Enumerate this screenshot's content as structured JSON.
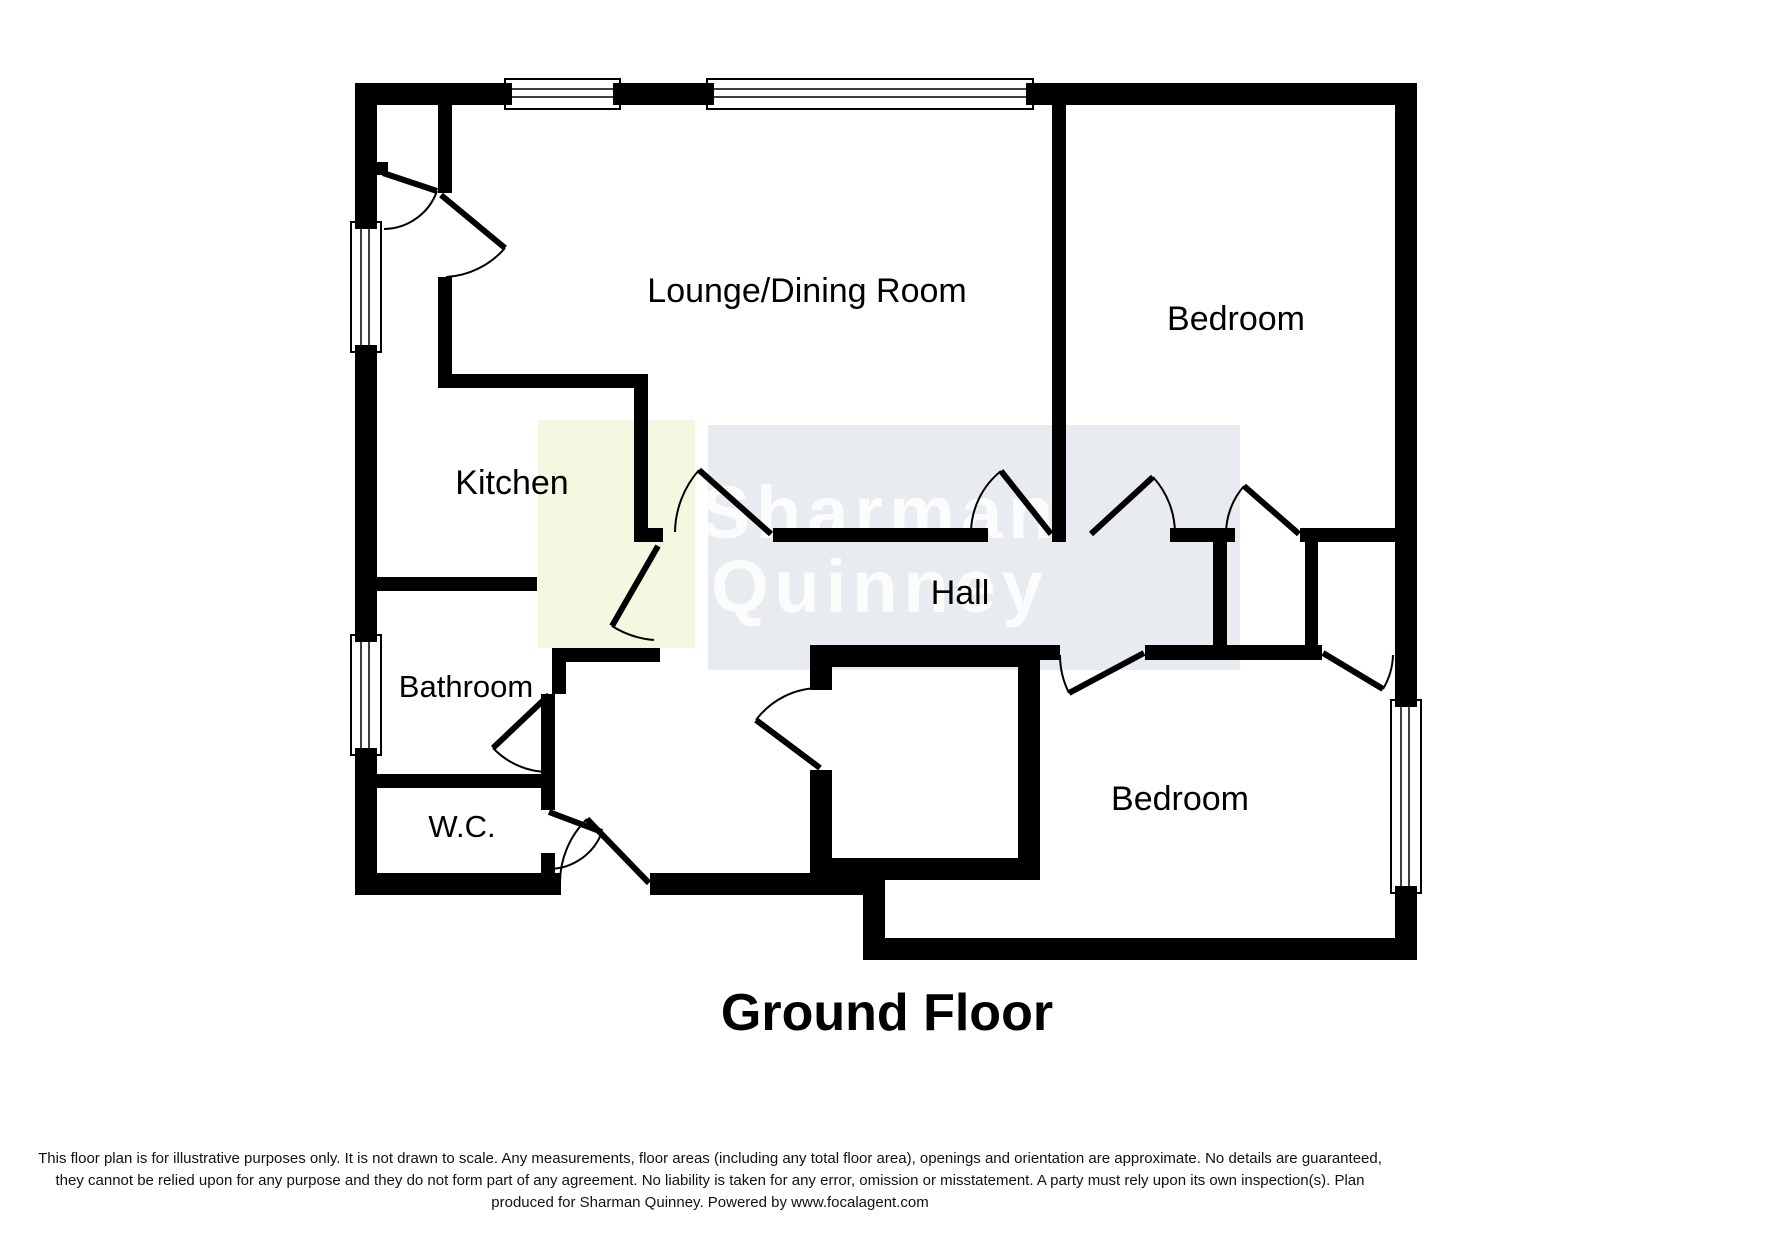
{
  "floor_plan": {
    "title": "Ground Floor",
    "brand_watermark": {
      "line1": "Sharman",
      "line2": "Quinney"
    },
    "rooms": [
      {
        "id": "lounge-dining-room",
        "label": "Lounge/Dining Room"
      },
      {
        "id": "bedroom-1",
        "label": "Bedroom"
      },
      {
        "id": "kitchen",
        "label": "Kitchen"
      },
      {
        "id": "hall",
        "label": "Hall"
      },
      {
        "id": "bathroom",
        "label": "Bathroom"
      },
      {
        "id": "wc",
        "label": "W.C."
      },
      {
        "id": "bedroom-2",
        "label": "Bedroom"
      }
    ],
    "colors": {
      "wall": "#000000",
      "background": "#ffffff",
      "kitchen_tint": "#f5f6de",
      "watermark_box": "#e7eaee",
      "watermark_text": "#ffffff"
    }
  },
  "disclaimer": {
    "line1": "This floor plan is for illustrative purposes only. It is not drawn to scale. Any measurements, floor areas (including any total floor area), openings and orientation are approximate. No details are guaranteed,",
    "line2": "they cannot be relied upon for any purpose and they do not form part of any agreement. No liability is taken for any error, omission or misstatement. A party must rely upon its own inspection(s). Plan",
    "line3": "produced for Sharman Quinney. Powered by www.focalagent.com"
  }
}
